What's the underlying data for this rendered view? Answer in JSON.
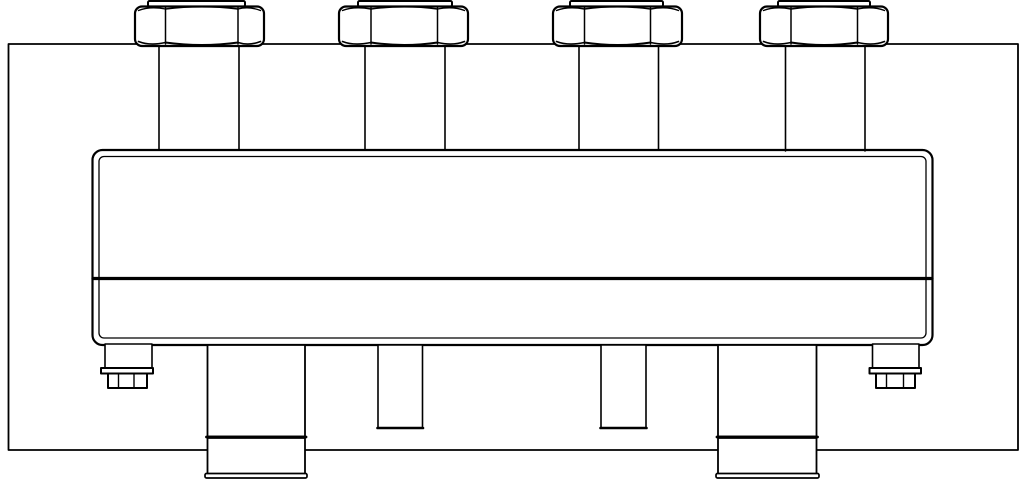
{
  "meta": {
    "background": "#ffffff",
    "stroke_color": "#000000"
  },
  "drawing": {
    "frame": {
      "shapes": [
        {
          "t": "rect",
          "a": {
            "x": 8.5,
            "y": 44,
            "width": 1009.5,
            "height": 406,
            "stroke-width": 1.8
          }
        }
      ]
    },
    "unions": [
      {
        "shapes": [
          {
            "t": "line",
            "a": {
              "x1": 159,
              "y1": 44,
              "x2": 159,
              "y2": 151,
              "stroke-width": 1.6
            }
          },
          {
            "t": "line",
            "a": {
              "x1": 239,
              "y1": 44,
              "x2": 239,
              "y2": 151,
              "stroke-width": 1.6
            }
          },
          {
            "t": "rect",
            "a": {
              "x": 148,
              "y": 1,
              "width": 97,
              "height": 5.5,
              "rx": 1.5,
              "fill": "#ffffff",
              "stroke-width": 2
            }
          },
          {
            "t": "rect",
            "a": {
              "x": 135,
              "y": 6.5,
              "width": 129,
              "height": 39.5,
              "rx": 7,
              "fill": "#ffffff",
              "stroke-width": 2.2
            }
          },
          {
            "t": "line",
            "a": {
              "x1": 165.5,
              "y1": 8,
              "x2": 165.5,
              "y2": 44,
              "stroke-width": 1.5
            }
          },
          {
            "t": "line",
            "a": {
              "x1": 238,
              "y1": 8,
              "x2": 238,
              "y2": 44,
              "stroke-width": 1.5
            }
          },
          {
            "t": "path",
            "a": {
              "d": "M 165.5 9 Q 201.8 4.5 238 9",
              "stroke-width": 1.6
            }
          },
          {
            "t": "path",
            "a": {
              "d": "M 165.5 42.5 Q 201.8 47.5 238 42.5",
              "stroke-width": 2
            }
          },
          {
            "t": "path",
            "a": {
              "d": "M 138.5 41.5 Q 150 46 165.5 42.5",
              "stroke-width": 1.6
            }
          },
          {
            "t": "path",
            "a": {
              "d": "M 238 42.5 Q 249 46 260.5 41.5",
              "stroke-width": 1.6
            }
          },
          {
            "t": "path",
            "a": {
              "d": "M 138.5 10.5 Q 150 6 165.5 9",
              "stroke-width": 1.4
            }
          },
          {
            "t": "path",
            "a": {
              "d": "M 238 9 Q 249 6 260.5 10.5",
              "stroke-width": 1.4
            }
          }
        ]
      },
      {
        "shapes": [
          {
            "t": "line",
            "a": {
              "x1": 365,
              "y1": 44,
              "x2": 365,
              "y2": 151,
              "stroke-width": 1.6
            }
          },
          {
            "t": "line",
            "a": {
              "x1": 445,
              "y1": 44,
              "x2": 445,
              "y2": 151,
              "stroke-width": 1.6
            }
          },
          {
            "t": "rect",
            "a": {
              "x": 358,
              "y": 1,
              "width": 94,
              "height": 5.5,
              "rx": 1.5,
              "fill": "#ffffff",
              "stroke-width": 2
            }
          },
          {
            "t": "rect",
            "a": {
              "x": 339,
              "y": 6.5,
              "width": 129,
              "height": 39.5,
              "rx": 7,
              "fill": "#ffffff",
              "stroke-width": 2.2
            }
          },
          {
            "t": "line",
            "a": {
              "x1": 371,
              "y1": 8,
              "x2": 371,
              "y2": 44,
              "stroke-width": 1.5
            }
          },
          {
            "t": "line",
            "a": {
              "x1": 437.5,
              "y1": 8,
              "x2": 437.5,
              "y2": 44,
              "stroke-width": 1.5
            }
          },
          {
            "t": "path",
            "a": {
              "d": "M 371 9 Q 404.3 4.5 437.5 9",
              "stroke-width": 1.6
            }
          },
          {
            "t": "path",
            "a": {
              "d": "M 371 42.5 Q 404.3 47.5 437.5 42.5",
              "stroke-width": 2
            }
          },
          {
            "t": "path",
            "a": {
              "d": "M 342.5 41.5 Q 354 46 371 42.5",
              "stroke-width": 1.6
            }
          },
          {
            "t": "path",
            "a": {
              "d": "M 437.5 42.5 Q 453 46 464.5 41.5",
              "stroke-width": 1.6
            }
          },
          {
            "t": "path",
            "a": {
              "d": "M 342.5 10.5 Q 354 6 371 9",
              "stroke-width": 1.4
            }
          },
          {
            "t": "path",
            "a": {
              "d": "M 437.5 9 Q 453 6 464.5 10.5",
              "stroke-width": 1.4
            }
          }
        ]
      },
      {
        "shapes": [
          {
            "t": "line",
            "a": {
              "x1": 579,
              "y1": 44,
              "x2": 579,
              "y2": 151,
              "stroke-width": 1.6
            }
          },
          {
            "t": "line",
            "a": {
              "x1": 658.5,
              "y1": 44,
              "x2": 658.5,
              "y2": 151,
              "stroke-width": 1.6
            }
          },
          {
            "t": "rect",
            "a": {
              "x": 570,
              "y": 1,
              "width": 93,
              "height": 5.5,
              "rx": 1.5,
              "fill": "#ffffff",
              "stroke-width": 2
            }
          },
          {
            "t": "rect",
            "a": {
              "x": 553,
              "y": 6.5,
              "width": 129,
              "height": 39.5,
              "rx": 7,
              "fill": "#ffffff",
              "stroke-width": 2.2
            }
          },
          {
            "t": "line",
            "a": {
              "x1": 584.5,
              "y1": 8,
              "x2": 584.5,
              "y2": 44,
              "stroke-width": 1.5
            }
          },
          {
            "t": "line",
            "a": {
              "x1": 650.5,
              "y1": 8,
              "x2": 650.5,
              "y2": 44,
              "stroke-width": 1.5
            }
          },
          {
            "t": "path",
            "a": {
              "d": "M 584.5 9 Q 617.5 4.5 650.5 9",
              "stroke-width": 1.6
            }
          },
          {
            "t": "path",
            "a": {
              "d": "M 584.5 42.5 Q 617.5 47.5 650.5 42.5",
              "stroke-width": 2
            }
          },
          {
            "t": "path",
            "a": {
              "d": "M 556.5 41.5 Q 568 46 584.5 42.5",
              "stroke-width": 1.6
            }
          },
          {
            "t": "path",
            "a": {
              "d": "M 650.5 42.5 Q 667 46 678.5 41.5",
              "stroke-width": 1.6
            }
          },
          {
            "t": "path",
            "a": {
              "d": "M 556.5 10.5 Q 568 6 584.5 9",
              "stroke-width": 1.4
            }
          },
          {
            "t": "path",
            "a": {
              "d": "M 650.5 9 Q 667 6 678.5 10.5",
              "stroke-width": 1.4
            }
          }
        ]
      },
      {
        "shapes": [
          {
            "t": "line",
            "a": {
              "x1": 785.5,
              "y1": 44,
              "x2": 785.5,
              "y2": 151,
              "stroke-width": 1.6
            }
          },
          {
            "t": "line",
            "a": {
              "x1": 865,
              "y1": 44,
              "x2": 865,
              "y2": 151,
              "stroke-width": 1.6
            }
          },
          {
            "t": "rect",
            "a": {
              "x": 778,
              "y": 1,
              "width": 92,
              "height": 5.5,
              "rx": 1.5,
              "fill": "#ffffff",
              "stroke-width": 2
            }
          },
          {
            "t": "rect",
            "a": {
              "x": 760,
              "y": 6.5,
              "width": 128,
              "height": 39.5,
              "rx": 7,
              "fill": "#ffffff",
              "stroke-width": 2.2
            }
          },
          {
            "t": "line",
            "a": {
              "x1": 791,
              "y1": 8,
              "x2": 791,
              "y2": 44,
              "stroke-width": 1.5
            }
          },
          {
            "t": "line",
            "a": {
              "x1": 857.5,
              "y1": 8,
              "x2": 857.5,
              "y2": 44,
              "stroke-width": 1.5
            }
          },
          {
            "t": "path",
            "a": {
              "d": "M 791 9 Q 824.3 4.5 857.5 9",
              "stroke-width": 1.6
            }
          },
          {
            "t": "path",
            "a": {
              "d": "M 791 42.5 Q 824.3 47.5 857.5 42.5",
              "stroke-width": 2
            }
          },
          {
            "t": "path",
            "a": {
              "d": "M 763.5 41.5 Q 775 46 791 42.5",
              "stroke-width": 1.6
            }
          },
          {
            "t": "path",
            "a": {
              "d": "M 857.5 42.5 Q 873 46 884.5 41.5",
              "stroke-width": 1.6
            }
          },
          {
            "t": "path",
            "a": {
              "d": "M 763.5 10.5 Q 775 6 791 9",
              "stroke-width": 1.4
            }
          },
          {
            "t": "path",
            "a": {
              "d": "M 857.5 9 Q 873 6 884.5 10.5",
              "stroke-width": 1.4
            }
          }
        ]
      }
    ],
    "body": {
      "shapes": [
        {
          "t": "rect",
          "a": {
            "x": 92.5,
            "y": 150,
            "width": 840,
            "height": 195,
            "rx": 10,
            "fill": "#ffffff",
            "stroke-width": 2.2
          }
        },
        {
          "t": "rect",
          "a": {
            "x": 99,
            "y": 156.5,
            "width": 827,
            "height": 181.5,
            "rx": 5,
            "stroke-width": 1.3
          }
        },
        {
          "t": "line",
          "a": {
            "x1": 93,
            "y1": 278.5,
            "x2": 932,
            "y2": 278.5,
            "stroke-width": 3.2
          }
        }
      ]
    },
    "pipe_stubs": [
      {
        "shapes": [
          {
            "t": "rect",
            "a": {
              "x": 378,
              "y": 345,
              "width": 44.5,
              "height": 83,
              "fill": "#ffffff",
              "stroke-width": 1.6
            }
          },
          {
            "t": "line",
            "a": {
              "x1": 377.5,
              "y1": 428,
              "x2": 423,
              "y2": 428,
              "stroke-width": 2.6
            }
          }
        ]
      },
      {
        "shapes": [
          {
            "t": "rect",
            "a": {
              "x": 601,
              "y": 345,
              "width": 45,
              "height": 83,
              "fill": "#ffffff",
              "stroke-width": 1.6
            }
          },
          {
            "t": "line",
            "a": {
              "x1": 600.5,
              "y1": 428,
              "x2": 646.5,
              "y2": 428,
              "stroke-width": 2.6
            }
          }
        ]
      }
    ],
    "supports": [
      {
        "shapes": [
          {
            "t": "rect",
            "a": {
              "x": 207.5,
              "y": 345,
              "width": 97.5,
              "height": 91.5,
              "fill": "#ffffff",
              "stroke-width": 1.8
            }
          },
          {
            "t": "rect",
            "a": {
              "x": 207.5,
              "y": 438,
              "width": 97.5,
              "height": 36,
              "fill": "#ffffff",
              "stroke-width": 1.8
            }
          },
          {
            "t": "line",
            "a": {
              "x1": 206.5,
              "y1": 437,
              "x2": 306,
              "y2": 437,
              "stroke-width": 2.8
            }
          },
          {
            "t": "rect",
            "a": {
              "x": 205,
              "y": 473.5,
              "width": 102,
              "height": 4.5,
              "rx": 1.5,
              "fill": "#ffffff",
              "stroke-width": 1.7
            }
          }
        ]
      },
      {
        "shapes": [
          {
            "t": "rect",
            "a": {
              "x": 718,
              "y": 345,
              "width": 98.5,
              "height": 91.5,
              "fill": "#ffffff",
              "stroke-width": 1.8
            }
          },
          {
            "t": "rect",
            "a": {
              "x": 718,
              "y": 438,
              "width": 98.5,
              "height": 36,
              "fill": "#ffffff",
              "stroke-width": 1.8
            }
          },
          {
            "t": "line",
            "a": {
              "x1": 717,
              "y1": 437,
              "x2": 817.5,
              "y2": 437,
              "stroke-width": 2.8
            }
          },
          {
            "t": "rect",
            "a": {
              "x": 716,
              "y": 473.5,
              "width": 103,
              "height": 4.5,
              "rx": 1.5,
              "fill": "#ffffff",
              "stroke-width": 1.7
            }
          }
        ]
      }
    ],
    "drain_fittings": [
      {
        "shapes": [
          {
            "t": "rect",
            "a": {
              "x": 105,
              "y": 344,
              "width": 47,
              "height": 24,
              "fill": "#ffffff",
              "stroke-width": 1.6
            }
          },
          {
            "t": "rect",
            "a": {
              "x": 101,
              "y": 368,
              "width": 52,
              "height": 5.5,
              "fill": "#ffffff",
              "stroke-width": 2
            }
          },
          {
            "t": "rect",
            "a": {
              "x": 108,
              "y": 373.5,
              "width": 39,
              "height": 14.5,
              "fill": "#ffffff",
              "stroke-width": 2
            }
          },
          {
            "t": "line",
            "a": {
              "x1": 118.5,
              "y1": 374.5,
              "x2": 118.5,
              "y2": 387.5,
              "stroke-width": 1.4
            }
          },
          {
            "t": "line",
            "a": {
              "x1": 134,
              "y1": 374.5,
              "x2": 134,
              "y2": 387.5,
              "stroke-width": 1.4
            }
          }
        ]
      },
      {
        "shapes": [
          {
            "t": "rect",
            "a": {
              "x": 872.5,
              "y": 344,
              "width": 46.5,
              "height": 24,
              "fill": "#ffffff",
              "stroke-width": 1.6
            }
          },
          {
            "t": "rect",
            "a": {
              "x": 869.5,
              "y": 368,
              "width": 51.5,
              "height": 5.5,
              "fill": "#ffffff",
              "stroke-width": 2
            }
          },
          {
            "t": "rect",
            "a": {
              "x": 876,
              "y": 373.5,
              "width": 39,
              "height": 14.5,
              "fill": "#ffffff",
              "stroke-width": 2
            }
          },
          {
            "t": "line",
            "a": {
              "x1": 886.5,
              "y1": 374.5,
              "x2": 886.5,
              "y2": 387.5,
              "stroke-width": 1.4
            }
          },
          {
            "t": "line",
            "a": {
              "x1": 903.5,
              "y1": 374.5,
              "x2": 903.5,
              "y2": 387.5,
              "stroke-width": 1.4
            }
          }
        ]
      }
    ]
  }
}
